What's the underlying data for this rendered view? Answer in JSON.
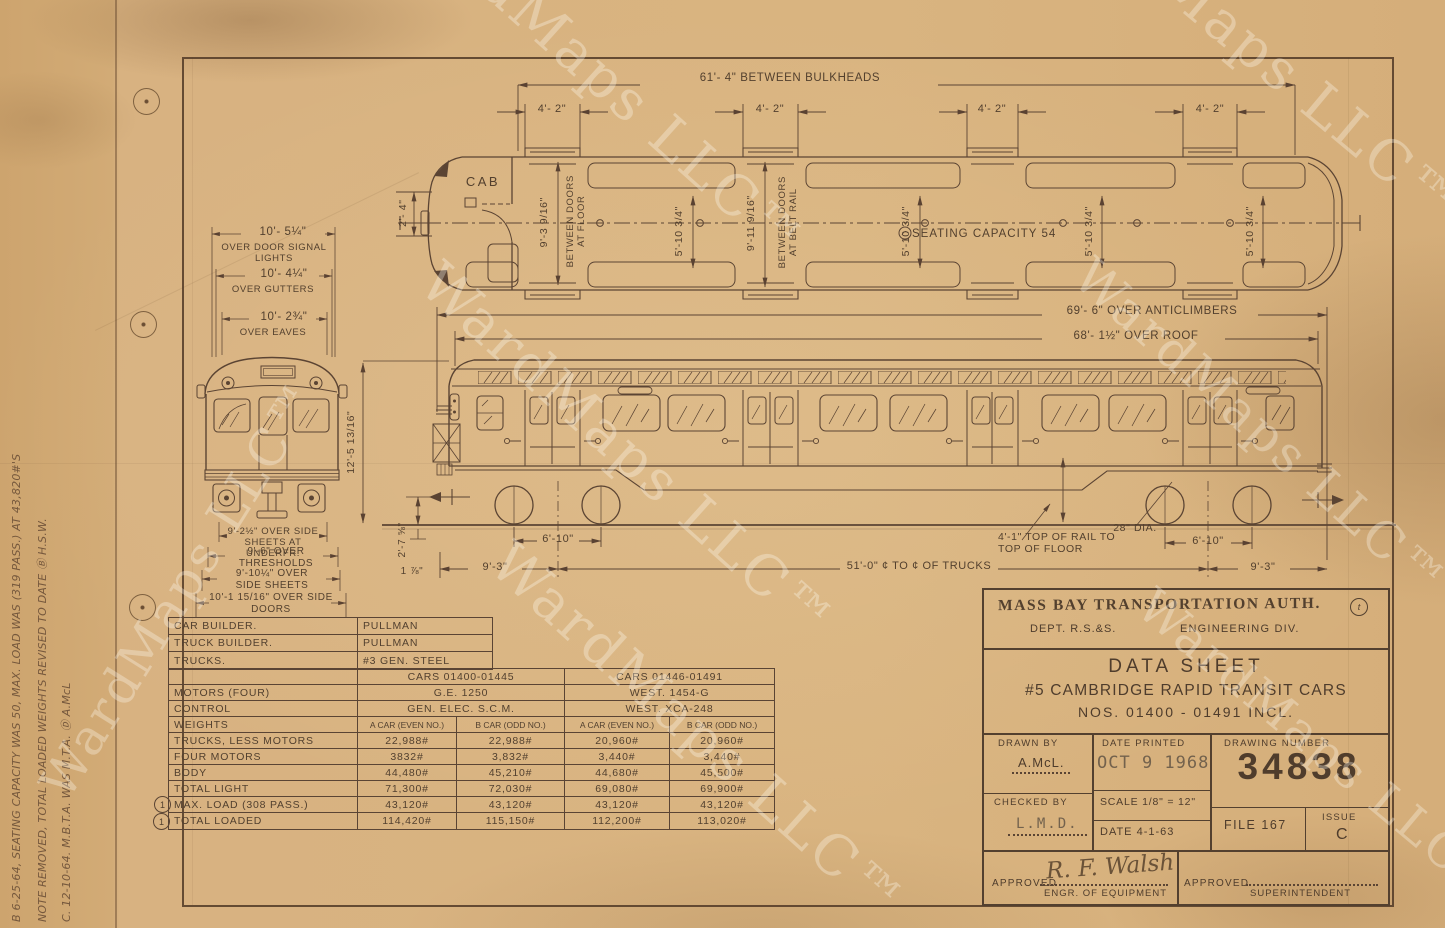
{
  "watermark": {
    "text": "WardMaps LLC™"
  },
  "margin_notes": {
    "line1": "B 6-25-64, SEATING CAPACITY WAS 50, MAX. LOAD WAS (319 PASS.) AT 43,820#'S",
    "line2": "NOTE REMOVED, TOTAL LOADED WEIGHTS REVISED TO DATE Ⓑ H.S.W.",
    "line3": "C. 12-10-64.  M.B.T.A. WAS M.T.A.  Ⓓ A.McL"
  },
  "plan_view": {
    "cab_label": "CAB",
    "dim_between_bulkheads": "61'- 4\" BETWEEN BULKHEADS",
    "dim_door_opening": "4'- 2\"",
    "dim_nose": "2'- 4\"",
    "dim_between_doors_floor": "9'-3 9/16\"",
    "between_doors_floor_label": "BETWEEN DOORS\nAT FLOOR",
    "dim_car_width": "5'-10 3/4\"",
    "dim_between_doors_beltrail": "9'-11 9/16\"",
    "between_doors_beltrail_label": "BETWEEN DOORS\nAT BELT RAIL",
    "seating_capacity": "SEATING CAPACITY 54"
  },
  "side_elevation": {
    "dim_over_anticlimbers": "69'- 6\" OVER ANTICLIMBERS",
    "dim_over_roof": "68'- 1½\" OVER ROOF",
    "dim_height_rail_to_roof": "12'-5 13/16\"",
    "dim_coupler_height": "2'-7 ⅝\"",
    "dim_small": "1 ⅞\"",
    "dim_truck_wheelbase": "6'-10\"",
    "dim_truck_overhang": "9'-3\"",
    "dim_truck_centers": "51'-0\" ¢ TO ¢ OF TRUCKS",
    "dim_rail_to_floor": "4'-1\" TOP OF RAIL TO\nTOP OF FLOOR",
    "wheel_diameter": "28\" DIA."
  },
  "front_view": {
    "dims_top": [
      {
        "value": "10'- 5¼\"",
        "label": "OVER DOOR SIGNAL LIGHTS"
      },
      {
        "value": "10'- 4¼\"",
        "label": "OVER GUTTERS"
      },
      {
        "value": "10'- 2¾\"",
        "label": "OVER EAVES"
      }
    ],
    "dims_bottom": [
      {
        "text": "9'-2½\" OVER SIDE\nSHEETS AT UNDERFR."
      },
      {
        "text": "9'-6\" OVER\nTHRESHOLDS"
      },
      {
        "text": "9'-10¼\" OVER\nSIDE SHEETS"
      },
      {
        "text": "10'-1 15/16\" OVER SIDE\nDOORS"
      }
    ]
  },
  "spec_table": {
    "builder_rows": [
      [
        "CAR BUILDER.",
        "PULLMAN"
      ],
      [
        "TRUCK BUILDER.",
        "PULLMAN"
      ],
      [
        "TRUCKS.",
        "#3 GEN. STEEL"
      ]
    ],
    "group_headers": [
      "CARS 01400-01445",
      "CARS 01446-01491"
    ],
    "motors_row": {
      "label": "MOTORS (FOUR)",
      "ge": "G.E. 1250",
      "west": "WEST. 1454-G"
    },
    "control_row": {
      "label": "CONTROL",
      "ge": "GEN. ELEC. S.C.M.",
      "west": "WEST. XCA-248"
    },
    "weights_row": {
      "label": "WEIGHTS",
      "cols": [
        "A CAR (EVEN NO.)",
        "B CAR (ODD NO.)",
        "A CAR (EVEN NO.)",
        "B CAR (ODD NO.)"
      ]
    },
    "weight_rows": [
      {
        "label": "TRUCKS, LESS MOTORS",
        "values": [
          "22,988#",
          "22,988#",
          "20,960#",
          "20,960#"
        ]
      },
      {
        "label": "FOUR MOTORS",
        "values": [
          "3832#",
          "3,832#",
          "3,440#",
          "3,440#"
        ]
      },
      {
        "label": "BODY",
        "values": [
          "44,480#",
          "45,210#",
          "44,680#",
          "45,500#"
        ]
      },
      {
        "label": "TOTAL LIGHT",
        "values": [
          "71,300#",
          "72,030#",
          "69,080#",
          "69,900#"
        ]
      },
      {
        "label": "MAX. LOAD (308 PASS.)",
        "values": [
          "43,120#",
          "43,120#",
          "43,120#",
          "43,120#"
        ],
        "mark": "1"
      },
      {
        "label": "TOTAL LOADED",
        "values": [
          "114,420#",
          "115,150#",
          "112,200#",
          "113,020#"
        ],
        "mark": "1"
      }
    ]
  },
  "title_block": {
    "authority": "MASS BAY TRANSPORTATION AUTH.",
    "corner_mark": "t",
    "dept": "DEPT. R.S.&S.",
    "division": "ENGINEERING DIV.",
    "sheet_title": "DATA SHEET",
    "subtitle": "#5 CAMBRIDGE RAPID TRANSIT CARS",
    "car_numbers": "NOS. 01400 - 01491 INCL.",
    "drawn_by_label": "DRAWN BY",
    "drawn_by": "A.McL.",
    "date_printed_label": "DATE PRINTED",
    "date_printed": "OCT 9  1968",
    "drawing_number_label": "DRAWING NUMBER",
    "drawing_number": "34838",
    "checked_by_label": "CHECKED BY",
    "checked_by": "L.M.D.",
    "scale": "SCALE 1/8\" = 12\"",
    "date": "DATE 4-1-63",
    "file": "FILE 167",
    "issue_label": "ISSUE",
    "issue": "C",
    "approved_label": "APPROVED",
    "approved_signature": "R. F. Walsh",
    "engr_of_equipment": "ENGR. OF EQUIPMENT",
    "approved2_label": "APPROVED",
    "superintendent": "SUPERINTENDENT"
  }
}
